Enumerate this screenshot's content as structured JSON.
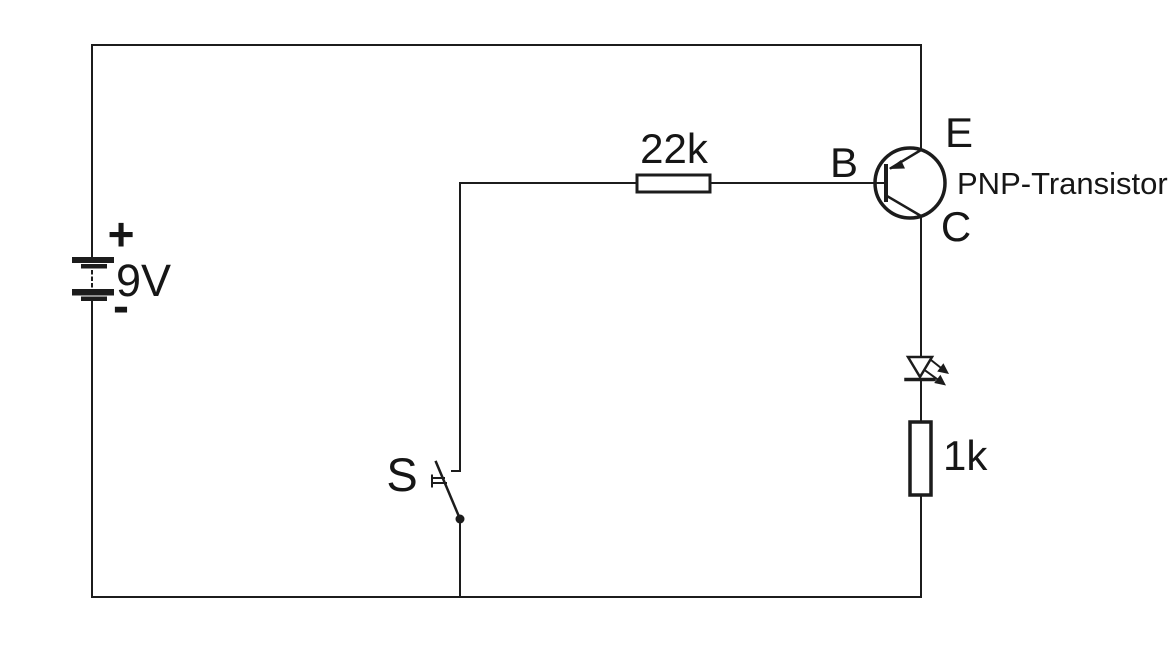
{
  "diagram": {
    "colors": {
      "background": "#ffffff",
      "line": "#1c1c1c",
      "text": "#161616"
    },
    "battery": {
      "plus_label": "+",
      "voltage_label": "9V",
      "minus_label": "-"
    },
    "switch": {
      "label": "S"
    },
    "base_resistor": {
      "value_label": "22k"
    },
    "load_resistor": {
      "value_label": "1k"
    },
    "transistor": {
      "base_label": "B",
      "emitter_label": "E",
      "collector_label": "C",
      "type_label": "PNP-Transistor"
    }
  }
}
